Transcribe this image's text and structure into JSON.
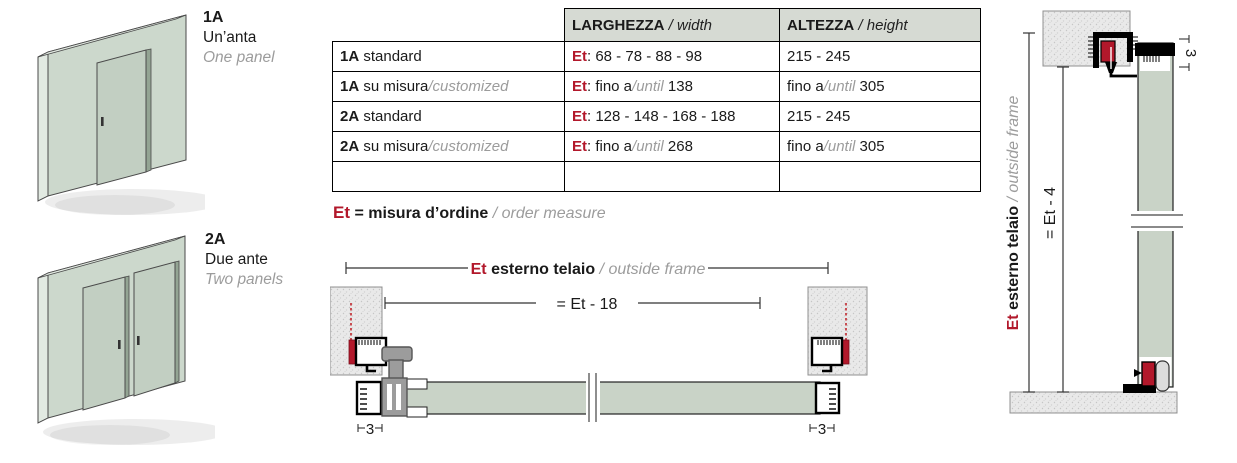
{
  "colors": {
    "accent_red": "#b2182b",
    "sage_wall": "#ccd8cc",
    "sage_door": "#c2cfc2",
    "sage_section": "#c9d3c7",
    "stipple_gray": "#e7e7e7",
    "header_bg": "#d6dad3",
    "gray_text": "#9c9c9c",
    "handle_gray": "#9c9c9c"
  },
  "illustrations": {
    "one_panel": {
      "code": "1A",
      "name_it": "Un’anta",
      "name_en": "One panel"
    },
    "two_panels": {
      "code": "2A",
      "name_it": "Due ante",
      "name_en": "Two panels"
    }
  },
  "table": {
    "headers": {
      "width_it": "LARGHEZZA",
      "width_en": " / width",
      "height_it": "ALTEZZA",
      "height_en": " / height"
    },
    "rows": [
      {
        "label_b": "1A",
        "label": " standard",
        "label_g": "",
        "w_et": "Et",
        "w_a": ": 68 - 78 - 88 - 98",
        "w_g": "",
        "w_b": "",
        "h_a": "215 - 245",
        "h_g": "",
        "h_b": ""
      },
      {
        "label_b": "1A",
        "label": " su misura",
        "label_g": "/customized",
        "w_et": "Et",
        "w_a": ": fino a",
        "w_g": "/until",
        "w_b": " 138",
        "h_a": "fino a",
        "h_g": "/until",
        "h_b": " 305"
      },
      {
        "label_b": "2A",
        "label": " standard",
        "label_g": "",
        "w_et": "Et",
        "w_a": ": 128 - 148 - 168 - 188",
        "w_g": "",
        "w_b": "",
        "h_a": "215 - 245",
        "h_g": "",
        "h_b": ""
      },
      {
        "label_b": "2A",
        "label": " su misura",
        "label_g": "/customized",
        "w_et": "Et",
        "w_a": ": fino a",
        "w_g": "/until",
        "w_b": " 268",
        "h_a": "fino a",
        "h_g": "/until",
        "h_b": " 305"
      },
      {
        "label_b": "",
        "label": "",
        "label_g": "",
        "w_et": "",
        "w_a": "",
        "w_g": "",
        "w_b": "",
        "h_a": "",
        "h_g": "",
        "h_b": ""
      }
    ]
  },
  "legend": {
    "et": "Et",
    "text": " = misura d’ordine ",
    "en": "/ order measure"
  },
  "plan_view": {
    "dim_outer": {
      "et": "Et",
      "it": " esterno telaio ",
      "en": "/ outside frame"
    },
    "dim_inner": "= Et - 18",
    "dim_left": "3",
    "dim_right": "3"
  },
  "side_view": {
    "dim_outer": {
      "et": "Et",
      "it": " esterno telaio ",
      "en": "/ outside frame"
    },
    "dim_inner": "= Et - 4",
    "dim_top": "3"
  }
}
